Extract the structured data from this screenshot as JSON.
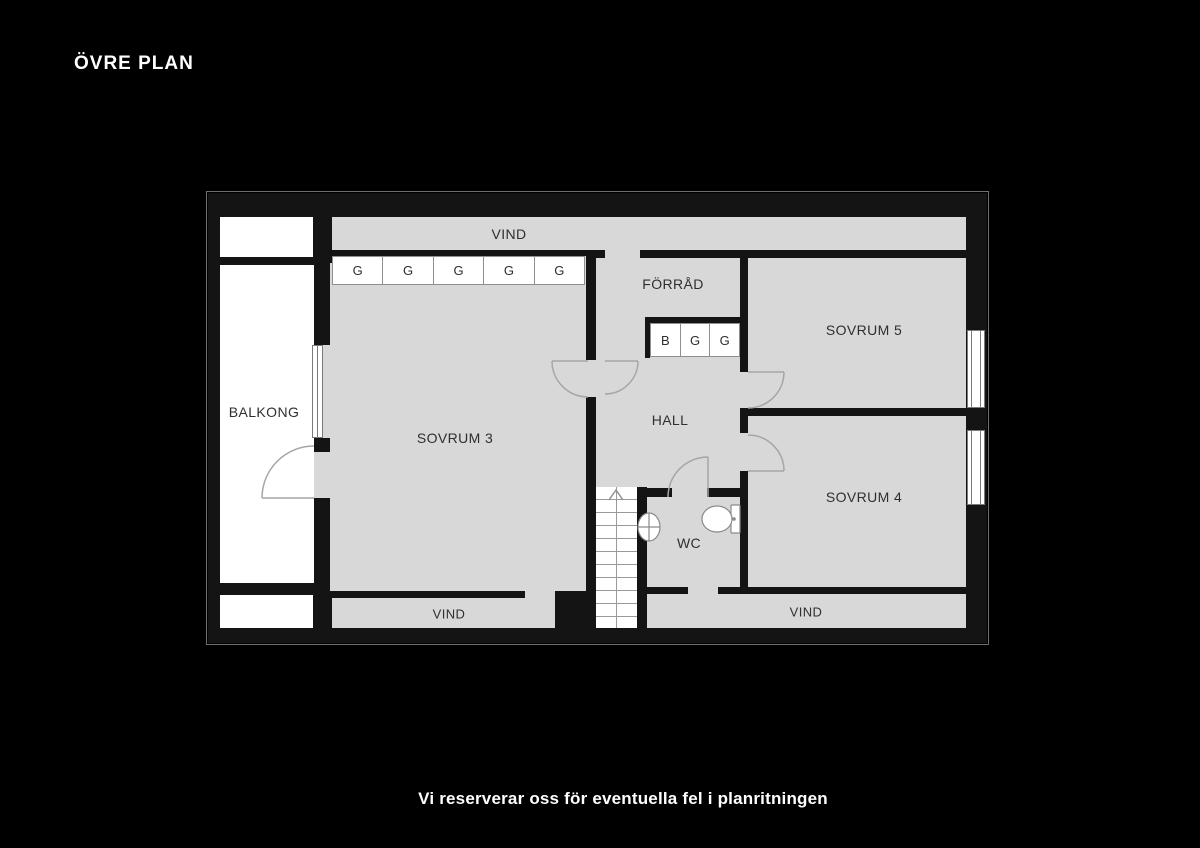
{
  "plan": {
    "title": "ÖVRE PLAN",
    "rooms": {
      "vind_top": "VIND",
      "forrad": "FÖRRÅD",
      "sovrum5": "SOVRUM 5",
      "balkong": "BALKONG",
      "sovrum3": "SOVRUM 3",
      "hall": "HALL",
      "sovrum4": "SOVRUM 4",
      "wc": "WC",
      "vind_bottom_left": "VIND",
      "vind_bottom_right": "VIND"
    },
    "wardrobes": {
      "g_row": [
        "G",
        "G",
        "G",
        "G",
        "G"
      ],
      "hall_row": [
        "B",
        "G",
        "G"
      ]
    },
    "icons": {
      "stairs_arrow": "stairs-up-arrow-icon",
      "toilet": "toilet-icon",
      "sink": "sink-icon"
    },
    "colors": {
      "background": "#000000",
      "floor": "#d8d8d8",
      "wall": "#141414",
      "balcony": "#ffffff",
      "label": "#2f2f2f",
      "door_arc": "#a6a6a6",
      "text": "#ffffff"
    }
  },
  "caption": "Vi reserverar oss för eventuella fel i planritningen"
}
